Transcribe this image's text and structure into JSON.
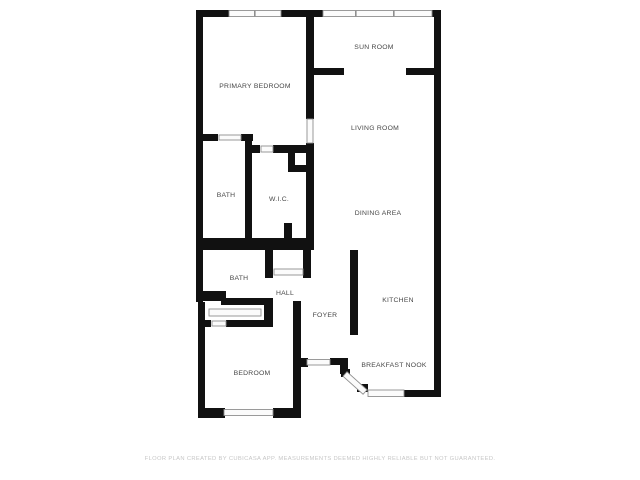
{
  "floor_plan": {
    "rooms": [
      {
        "label": "PRIMARY BEDROOM"
      },
      {
        "label": "SUN ROOM"
      },
      {
        "label": "LIVING ROOM"
      },
      {
        "label": "BATH"
      },
      {
        "label": "W.I.C."
      },
      {
        "label": "DINING AREA"
      },
      {
        "label": "BATH"
      },
      {
        "label": "HALL"
      },
      {
        "label": "FOYER"
      },
      {
        "label": "KITCHEN"
      },
      {
        "label": "BREAKFAST NOOK"
      },
      {
        "label": "BEDROOM"
      }
    ],
    "footer": "FLOOR PLAN CREATED BY CUBICASA APP. MEASUREMENTS DEEMED HIGHLY RELIABLE BUT NOT GUARANTEED.",
    "colors": {
      "background": "#ffffff",
      "wall": "#111111",
      "window_fill": "#fbfbfb",
      "window_border": "#8f8f8f",
      "label": "#474747",
      "footer": "#c7c7c7"
    }
  }
}
